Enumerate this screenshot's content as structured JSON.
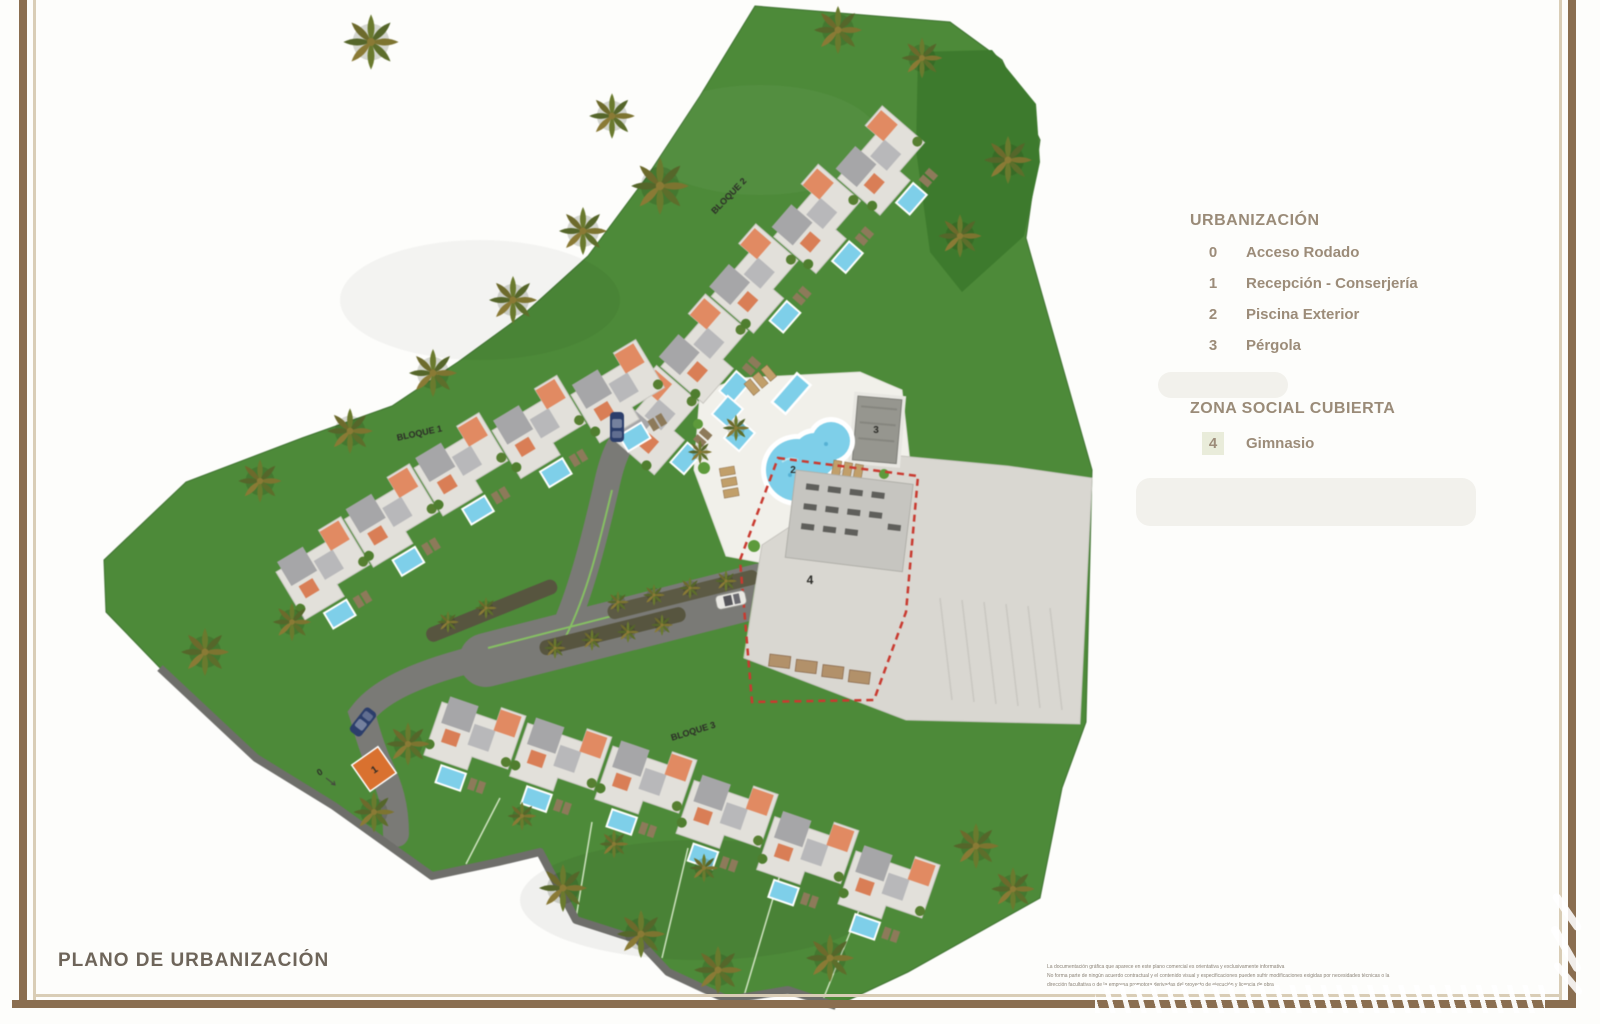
{
  "page": {
    "title": "PLANO DE URBANIZACIÓN"
  },
  "legend": {
    "sections": [
      {
        "title": "URBANIZACIÓN",
        "items": [
          {
            "num": "0",
            "label": "Acceso Rodado"
          },
          {
            "num": "1",
            "label": "Recepción - Conserjería"
          },
          {
            "num": "2",
            "label": "Piscina Exterior"
          },
          {
            "num": "3",
            "label": "Pérgola"
          }
        ]
      },
      {
        "title": "ZONA SOCIAL CUBIERTA",
        "items": [
          {
            "num": "4",
            "label": "Gimnasio"
          }
        ]
      }
    ]
  },
  "map": {
    "block_labels": [
      {
        "label": "BLOQUE 1"
      },
      {
        "label": "BLOQUE 2"
      },
      {
        "label": "BLOQUE 3"
      }
    ],
    "markers": [
      {
        "num": "0"
      },
      {
        "num": "1"
      },
      {
        "num": "2"
      },
      {
        "num": "3"
      },
      {
        "num": "4"
      }
    ]
  },
  "footer": {
    "disclaimer_lines": [
      "La documentación gráfica que aparece en este plano comercial es orientativa y exclusivamente informativa",
      "No forma parte de ningún acuerdo contractual y el contenido visual y especificaciones pueden sufrir modificaciones exigidas por necesidades técnicas o la",
      "dirección facultativa o de la empresa promotora derivadas del proyecto de ejecución y licencia de obra"
    ]
  },
  "colors": {
    "grass": "#4d8a39",
    "grass_dark": "#3d7a2d",
    "road": "#7a7a76",
    "pool_blue": "#7ecfe9",
    "roof_orange": "#e18a62",
    "roof_gray": "#a6a6a8",
    "plaza": "#d9d7d1",
    "boundary_red_dash": "#c93a30",
    "frame_brown": "#8a6e50",
    "legend_text": "#9c8c79"
  }
}
